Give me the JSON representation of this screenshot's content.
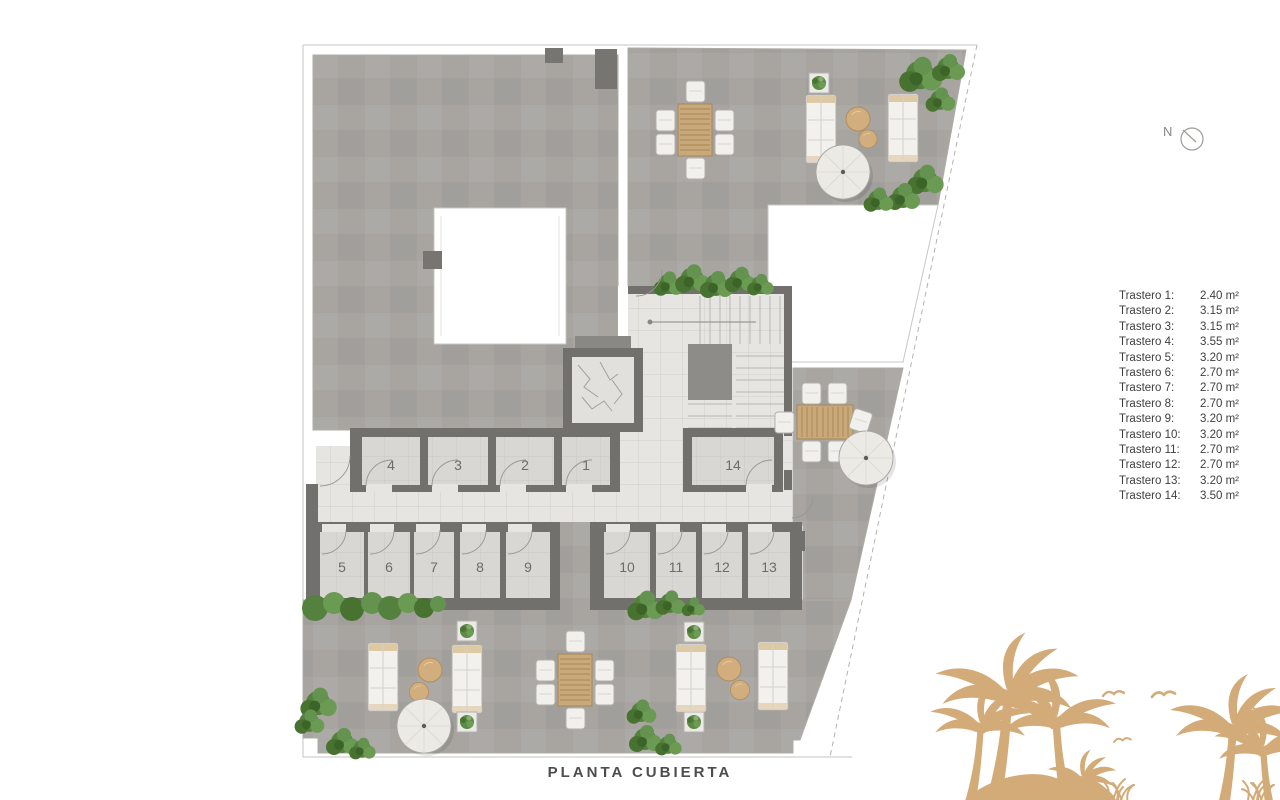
{
  "title": "PLANTA CUBIERTA",
  "compass": {
    "label": "N"
  },
  "legend": {
    "items": [
      {
        "name": "Trastero 1:",
        "area": "2.40 m²"
      },
      {
        "name": "Trastero 2:",
        "area": "3.15 m²"
      },
      {
        "name": "Trastero 3:",
        "area": "3.15 m²"
      },
      {
        "name": "Trastero 4:",
        "area": "3.55 m²"
      },
      {
        "name": "Trastero 5:",
        "area": "3.20 m²"
      },
      {
        "name": "Trastero 6:",
        "area": "2.70 m²"
      },
      {
        "name": "Trastero 7:",
        "area": "2.70 m²"
      },
      {
        "name": "Trastero 8:",
        "area": "2.70 m²"
      },
      {
        "name": "Trastero 9:",
        "area": "3.20 m²"
      },
      {
        "name": "Trastero 10:",
        "area": "3.20 m²"
      },
      {
        "name": "Trastero 11:",
        "area": "2.70 m²"
      },
      {
        "name": "Trastero 12:",
        "area": "2.70 m²"
      },
      {
        "name": "Trastero 13:",
        "area": "3.20 m²"
      },
      {
        "name": "Trastero 14:",
        "area": "3.50 m²"
      }
    ]
  },
  "plan": {
    "room_numbers": [
      "4",
      "3",
      "2",
      "1",
      "14",
      "5",
      "6",
      "7",
      "8",
      "9",
      "10",
      "11",
      "12",
      "13"
    ]
  },
  "colors": {
    "palm_silhouette": "#d3ab79",
    "terrace_tile": "#a8a5a1",
    "corridor_tile": "#e7e5e2",
    "room_tile": "#d9d7d3",
    "wall": "#71706d",
    "wood_furniture": "#c9a87a",
    "plant_green": "#55813f",
    "legend_text": "#3e3e3e",
    "title_text": "#4d4d4b"
  }
}
